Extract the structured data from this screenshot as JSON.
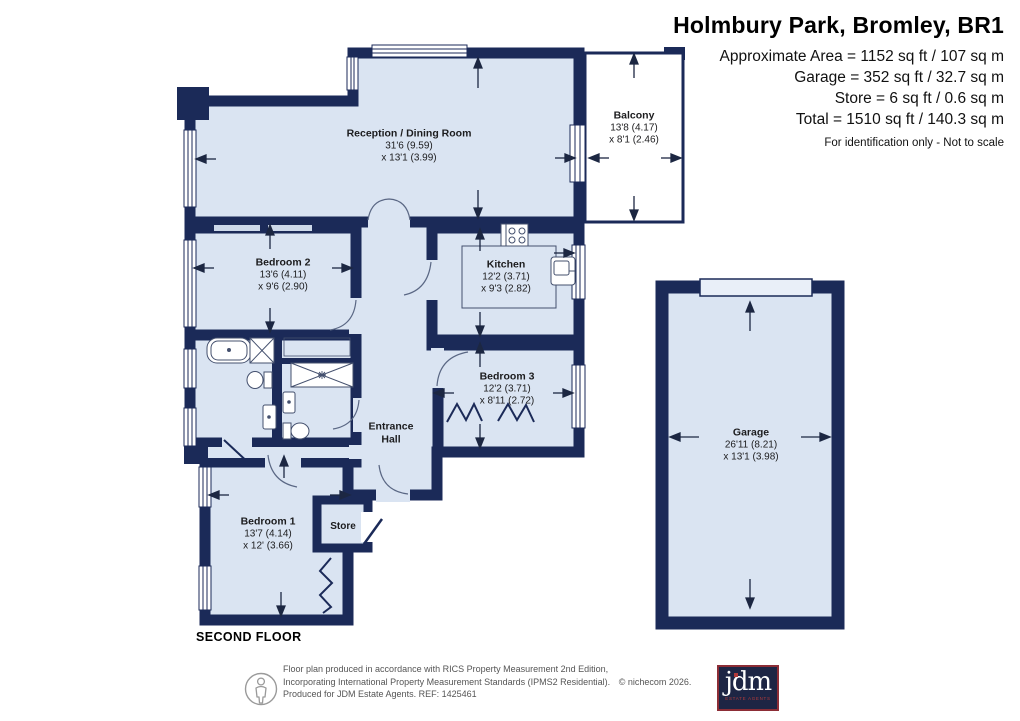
{
  "header": {
    "title": "Holmbury Park, Bromley, BR1",
    "area_lines": [
      "Approximate Area = 1152 sq ft / 107 sq m",
      "Garage = 352 sq ft / 32.7 sq m",
      "Store = 6 sq ft / 0.6 sq m",
      "Total = 1510 sq ft / 140.3 sq m"
    ],
    "disclaimer": "For identification only - Not to scale"
  },
  "floor_label": "SECOND FLOOR",
  "rooms": {
    "reception": {
      "name": "Reception / Dining Room",
      "dim1": "31'6 (9.59)",
      "dim2": "x 13'1 (3.99)"
    },
    "balcony": {
      "name": "Balcony",
      "dim1": "13'8 (4.17)",
      "dim2": "x 8'1 (2.46)"
    },
    "bedroom2": {
      "name": "Bedroom 2",
      "dim1": "13'6 (4.11)",
      "dim2": "x 9'6 (2.90)"
    },
    "kitchen": {
      "name": "Kitchen",
      "dim1": "12'2 (3.71)",
      "dim2": "x 9'3 (2.82)"
    },
    "bedroom3": {
      "name": "Bedroom 3",
      "dim1": "12'2 (3.71)",
      "dim2": "x 8'11 (2.72)"
    },
    "entrance_hall": {
      "line1": "Entrance",
      "line2": "Hall"
    },
    "bedroom1": {
      "name": "Bedroom 1",
      "dim1": "13'7 (4.14)",
      "dim2": "x 12' (3.66)"
    },
    "store": {
      "name": "Store"
    },
    "garage": {
      "name": "Garage",
      "dim1": "26'11 (8.21)",
      "dim2": "x 13'1 (3.98)"
    }
  },
  "footer": {
    "line1": "Floor plan produced in accordance with RICS Property Measurement 2nd Edition,",
    "line2": "Incorporating International Property Measurement Standards (IPMS2 Residential).",
    "copyright": "© nichecom 2026.",
    "line3": "Produced for JDM Estate Agents.    REF: 1425461"
  },
  "logo": {
    "text": "jdm",
    "subtext": "ESTATE AGENTS"
  },
  "colors": {
    "wall": "#1b2a58",
    "room_fill": "#dae4f2",
    "balcony_fill": "#ffffff",
    "fixture_line": "#44506e",
    "logo_bg": "#1d2544",
    "logo_border": "#8c2d36",
    "logo_accent": "#b03a3a",
    "footer_text": "#555555"
  }
}
